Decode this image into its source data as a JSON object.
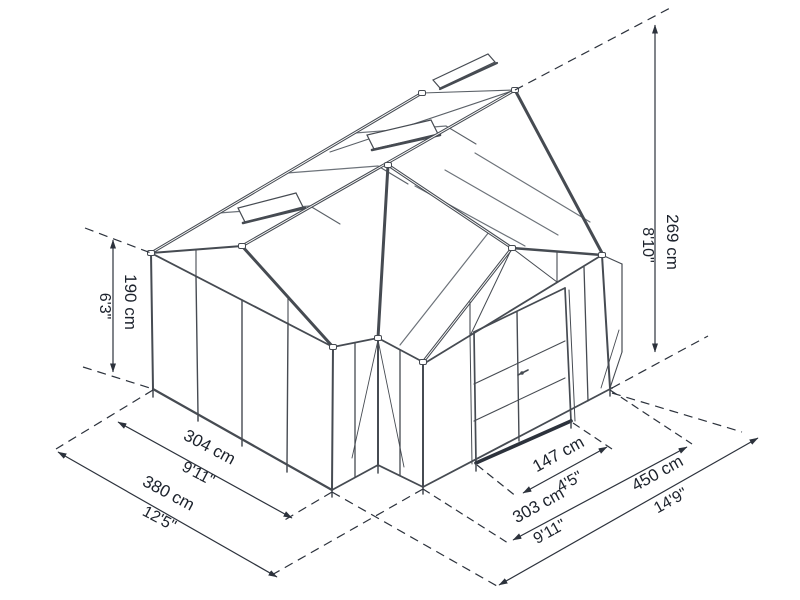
{
  "diagram": {
    "title": "greenhouse-dimension-diagram",
    "subject": "Isometric technical line drawing of a cross-gable greenhouse with roof vents and double doors, annotated with overall dimensions",
    "colors": {
      "line": "#464b52",
      "glazing_bar": "#6d737a",
      "dimension_line": "#2c323c",
      "text": "#1c222c",
      "background": "#ffffff"
    }
  },
  "dims": {
    "wall_height": {
      "cm": "190 cm",
      "ft": "6'3\""
    },
    "ridge_height": {
      "cm": "269 cm",
      "ft": "8'10\""
    },
    "side_width": {
      "cm": "304 cm",
      "ft": "9'11\""
    },
    "side_total": {
      "cm": "380 cm",
      "ft": "12'5\""
    },
    "door_width": {
      "cm": "147 cm",
      "ft": "4'5\""
    },
    "front_width": {
      "cm": "303 cm",
      "ft": "9'11\""
    },
    "front_total": {
      "cm": "450 cm",
      "ft": "14'9\""
    }
  }
}
